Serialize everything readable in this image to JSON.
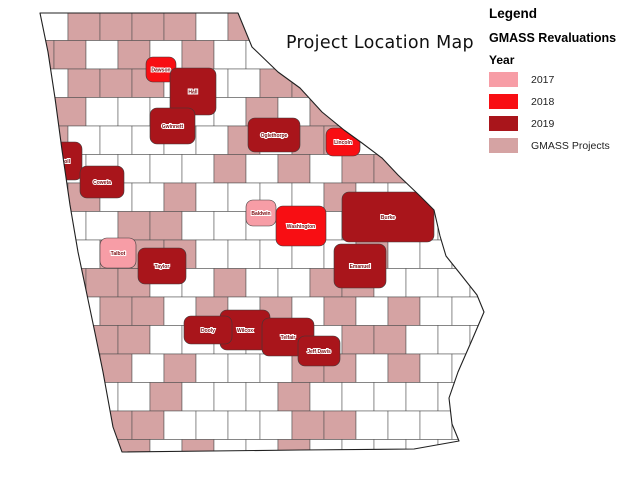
{
  "title": "Project Location Map",
  "legend": {
    "heading": "Legend",
    "subheading": "GMASS Revaluations",
    "year_label": "Year",
    "items": [
      {
        "label": "2017",
        "color": "#F79DA6"
      },
      {
        "label": "2018",
        "color": "#F80E13"
      },
      {
        "label": "2019",
        "color": "#A9151B"
      },
      {
        "label": "GMASS Projects",
        "color": "#D5A3A3"
      }
    ]
  },
  "map": {
    "state": "Georgia",
    "colors": {
      "county_fill": "#FFFFFF",
      "project_fill": "#D5A3A3",
      "border": "#4d4d4d",
      "outline": "#202020",
      "label_text": "#7c0a0e",
      "label_halo": "#ffffff"
    },
    "outline": [
      [
        40,
        13
      ],
      [
        238,
        13
      ],
      [
        252,
        47
      ],
      [
        278,
        72
      ],
      [
        300,
        88
      ],
      [
        322,
        112
      ],
      [
        344,
        130
      ],
      [
        362,
        143
      ],
      [
        382,
        158
      ],
      [
        398,
        175
      ],
      [
        420,
        196
      ],
      [
        434,
        210
      ],
      [
        440,
        236
      ],
      [
        446,
        256
      ],
      [
        462,
        276
      ],
      [
        477,
        295
      ],
      [
        484,
        312
      ],
      [
        472,
        340
      ],
      [
        458,
        372
      ],
      [
        449,
        398
      ],
      [
        452,
        424
      ],
      [
        459,
        441
      ],
      [
        414,
        449
      ],
      [
        300,
        450
      ],
      [
        122,
        452
      ],
      [
        113,
        427
      ],
      [
        103,
        372
      ],
      [
        95,
        333
      ],
      [
        86,
        290
      ],
      [
        78,
        252
      ],
      [
        70,
        205
      ],
      [
        62,
        150
      ],
      [
        55,
        98
      ],
      [
        48,
        52
      ]
    ],
    "grid": {
      "origin": [
        36,
        12
      ],
      "cell_w": 32,
      "cell_h": 28.5,
      "brick_offset": 14,
      "rows": [
        "WRRRRWRWWWWWWW",
        "RRWRWRWWRWWWWW",
        "WRRRWWWRRRWWWW",
        "RRWWWWWRWRWWWW",
        "RWWWWWRWRRWWWW",
        "WWWWWWRWRWRRWW",
        "WRWWRWWWWRWWWW",
        "RWWRRWWWWWRRWW",
        "RWRRRWWWWWRWWW",
        "WRRRWWRWWRRWWW",
        "WWRRWRWRWRWRWW",
        "RRRRWWWWWWRRWW",
        "WWRWRWWWRRWRWW",
        "WWWWRWWWRWWWWW",
        "RWRRWWWWRRWWWW",
        "WWWRWRWWRWWWWW"
      ]
    },
    "highlighted_counties": [
      {
        "name": "Dawson",
        "year": "2018",
        "x": 146,
        "y": 57,
        "w": 30,
        "h": 25
      },
      {
        "name": "Hall",
        "year": "2019",
        "x": 170,
        "y": 68,
        "w": 46,
        "h": 47
      },
      {
        "name": "Gwinnett",
        "year": "2019",
        "x": 150,
        "y": 108,
        "w": 45,
        "h": 36
      },
      {
        "name": "Oglethorpe",
        "year": "2019",
        "x": 248,
        "y": 118,
        "w": 52,
        "h": 34
      },
      {
        "name": "Lincoln",
        "year": "2018",
        "x": 326,
        "y": 128,
        "w": 34,
        "h": 28
      },
      {
        "name": "Carroll",
        "year": "2019",
        "x": 42,
        "y": 142,
        "w": 40,
        "h": 38
      },
      {
        "name": "Coweta",
        "year": "2019",
        "x": 80,
        "y": 166,
        "w": 44,
        "h": 32
      },
      {
        "name": "Burke",
        "year": "2019",
        "x": 342,
        "y": 192,
        "w": 92,
        "h": 50
      },
      {
        "name": "Baldwin",
        "year": "2017",
        "x": 246,
        "y": 200,
        "w": 30,
        "h": 26
      },
      {
        "name": "Washington",
        "year": "2018",
        "x": 276,
        "y": 206,
        "w": 50,
        "h": 40
      },
      {
        "name": "Talbot",
        "year": "2017",
        "x": 100,
        "y": 238,
        "w": 36,
        "h": 30
      },
      {
        "name": "Emanuel",
        "year": "2019",
        "x": 334,
        "y": 244,
        "w": 52,
        "h": 44
      },
      {
        "name": "Taylor",
        "year": "2019",
        "x": 138,
        "y": 248,
        "w": 48,
        "h": 36
      },
      {
        "name": "Wilcox",
        "year": "2019",
        "x": 220,
        "y": 310,
        "w": 50,
        "h": 40
      },
      {
        "name": "Dooly",
        "year": "2019",
        "x": 184,
        "y": 316,
        "w": 48,
        "h": 28
      },
      {
        "name": "Telfair",
        "year": "2019",
        "x": 262,
        "y": 318,
        "w": 52,
        "h": 38
      },
      {
        "name": "Jeff Davis",
        "year": "2019",
        "x": 298,
        "y": 336,
        "w": 42,
        "h": 30
      }
    ]
  }
}
